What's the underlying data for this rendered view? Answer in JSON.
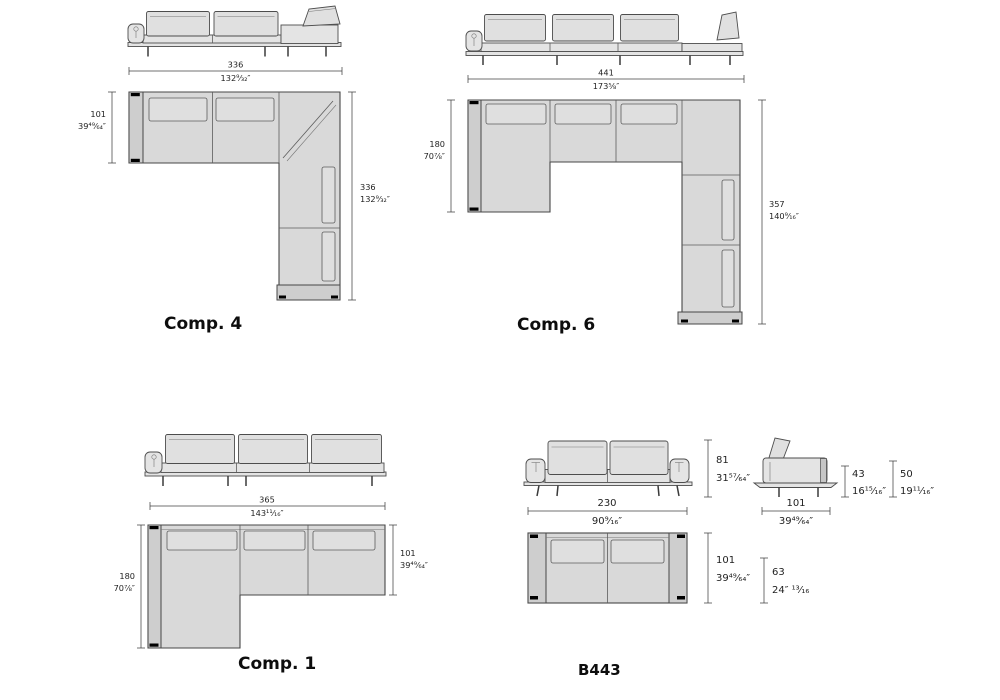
{
  "sheet": {
    "background": "#ffffff",
    "plan_fill": "#d9d9d9",
    "outline_color": "#474747",
    "dim_text_color": "#1f1f1f"
  },
  "configurations": {
    "comp4": {
      "label": "Comp. 4",
      "width_cm": "336",
      "width_in": "132⁹⁄₃₂″",
      "depth_cm": "101",
      "depth_in": "39⁴⁹⁄₆₄″",
      "length_cm": "336",
      "length_in": "132⁹⁄₃₂″"
    },
    "comp6": {
      "label": "Comp. 6",
      "width_cm": "441",
      "width_in": "173⅝″",
      "depth_cm": "180",
      "depth_in": "70⅞″",
      "length_cm": "357",
      "length_in": "140⁹⁄₁₆″"
    },
    "comp1": {
      "label": "Comp. 1",
      "width_cm": "365",
      "width_in": "143¹¹⁄₁₆″",
      "depth_cm": "180",
      "depth_in": "70⅞″",
      "seat_row_depth_cm": "101",
      "seat_row_depth_in": "39⁴⁹⁄₆₄″"
    },
    "b443": {
      "label": "B443",
      "height_cm": "81",
      "height_in": "31⁵⁷⁄₆₄″",
      "width_cm": "230",
      "width_in": "90⁹⁄₁₆″",
      "seat_height_cm": "43",
      "seat_height_in": "16¹⁵⁄₁₆″",
      "arm_height_cm": "50",
      "arm_height_in": "19¹¹⁄₁₆″",
      "side_depth_cm": "101",
      "side_depth_in": "39⁴⁹⁄₆₄″",
      "plan_depth_cm": "101",
      "plan_depth_in": "39⁴⁹⁄₆₄″",
      "seat_depth_cm": "63",
      "seat_depth_in": "24″ ¹³⁄₁₆"
    }
  }
}
